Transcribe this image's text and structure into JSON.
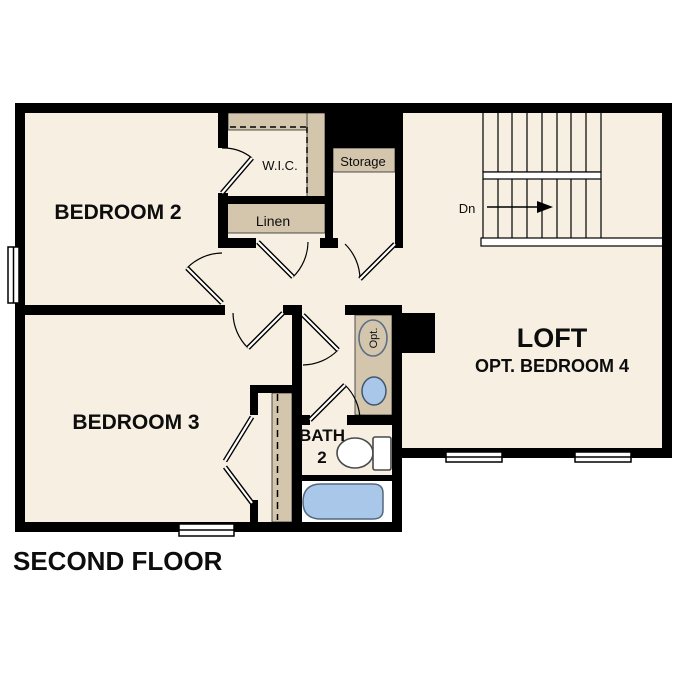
{
  "title": "SECOND FLOOR",
  "labels": {
    "bedroom2": "BEDROOM 2",
    "bedroom3": "BEDROOM 3",
    "loft": "LOFT",
    "loft_option": "OPT. BEDROOM 4",
    "bath_line1": "BATH",
    "bath_line2": "2",
    "wic": "W.I.C.",
    "storage": "Storage",
    "linen": "Linen",
    "stair_direction": "Dn",
    "optional_sink": "Opt."
  },
  "colors": {
    "background": "#ffffff",
    "floor": "#f6efe2",
    "shelf": "#d3c6ad",
    "wall": "#000000",
    "fixture": "#a9c8e9"
  }
}
